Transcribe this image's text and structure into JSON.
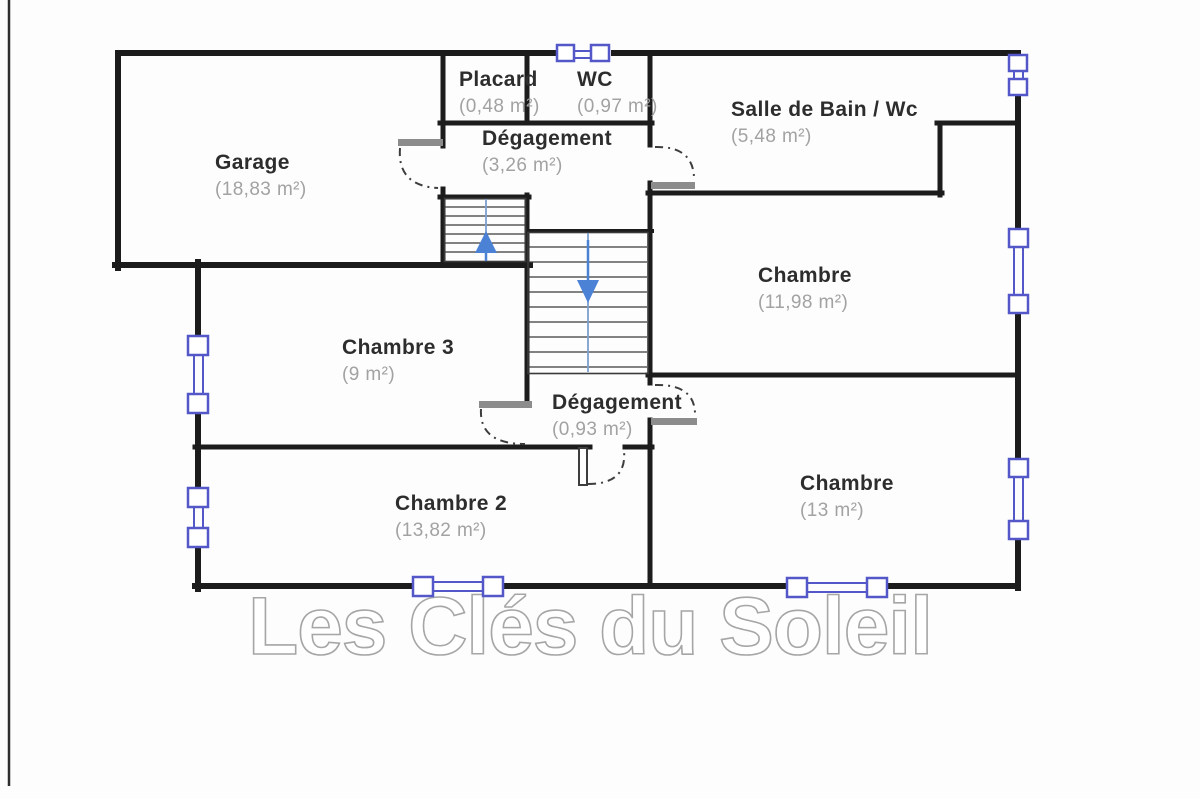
{
  "plan": {
    "watermark": "Les Clés du Soleil",
    "rooms": [
      {
        "id": "garage",
        "name": "Garage",
        "area": "(18,83 m²)"
      },
      {
        "id": "placard",
        "name": "Placard",
        "area": "(0,48 m²)"
      },
      {
        "id": "wc",
        "name": "WC",
        "area": "(0,97 m²)"
      },
      {
        "id": "degagement",
        "name": "Dégagement",
        "area": "(3,26 m²)"
      },
      {
        "id": "salle-de-bain",
        "name": "Salle de Bain / Wc",
        "area": "(5,48 m²)"
      },
      {
        "id": "chambre",
        "name": "Chambre",
        "area": "(11,98 m²)"
      },
      {
        "id": "chambre-3",
        "name": "Chambre 3",
        "area": "(9 m²)"
      },
      {
        "id": "degagement-2",
        "name": "Dégagement",
        "area": "(0,93 m²)"
      },
      {
        "id": "chambre-2",
        "name": "Chambre 2",
        "area": "(13,82 m²)"
      },
      {
        "id": "chambre-13",
        "name": "Chambre",
        "area": "(13 m²)"
      }
    ],
    "features": {
      "stairs_up_arrow": "up",
      "stairs_down_arrow": "down",
      "window_count": 8,
      "door_count": 5
    },
    "colors": {
      "wall": "#1c1c1c",
      "window_frame": "#5457c8",
      "stair_arrow": "#4b82d6",
      "door_leaf": "#8c8c8c",
      "room_title": "#2d2d2d",
      "room_area": "#a2a2a2",
      "watermark_outline": "#a6a6a6"
    }
  }
}
